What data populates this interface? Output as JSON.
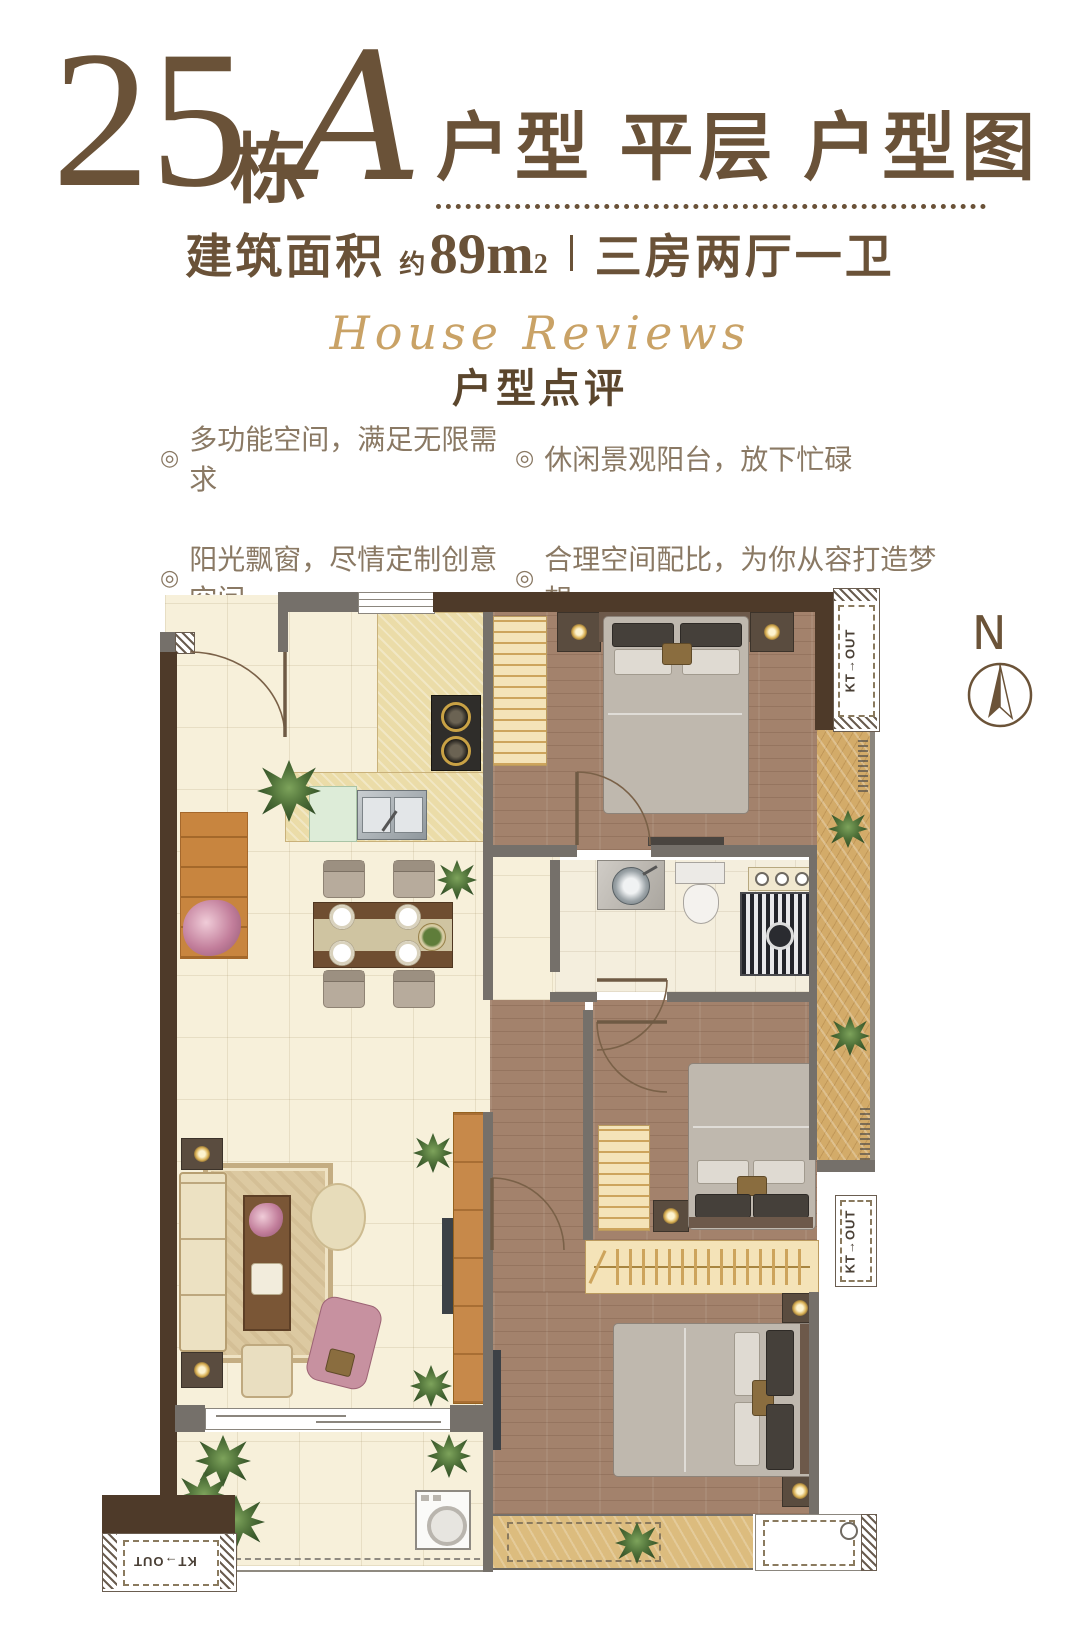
{
  "header": {
    "number": "25",
    "dong": "栋",
    "unit": "A",
    "title": "户型 平层  户型图",
    "area_label": "建筑面积",
    "area_prefix": "约",
    "area_value": "89m",
    "area_exp": "2",
    "layout": "三房两厅一卫"
  },
  "review": {
    "script": "House Reviews",
    "title": "户型点评",
    "marker": "◎",
    "bullets": [
      "多功能空间，满足无限需求",
      "休闲景观阳台，放下忙碌",
      "阳光飘窗，尽情定制创意空间",
      "合理空间配比，为你从容打造梦想"
    ]
  },
  "plan": {
    "compass": "N",
    "kt_out": "KT→OUT"
  },
  "colors": {
    "title_brown": "#6a5238",
    "script_gold": "#c9a266",
    "bullet_text": "#8a7964",
    "wall_gray": "#75706a",
    "wall_brown": "#4e3a29",
    "floor_cream": "#f7f0da",
    "floor_wood": "#a3826c",
    "floor_marble": "#d3ab69"
  }
}
